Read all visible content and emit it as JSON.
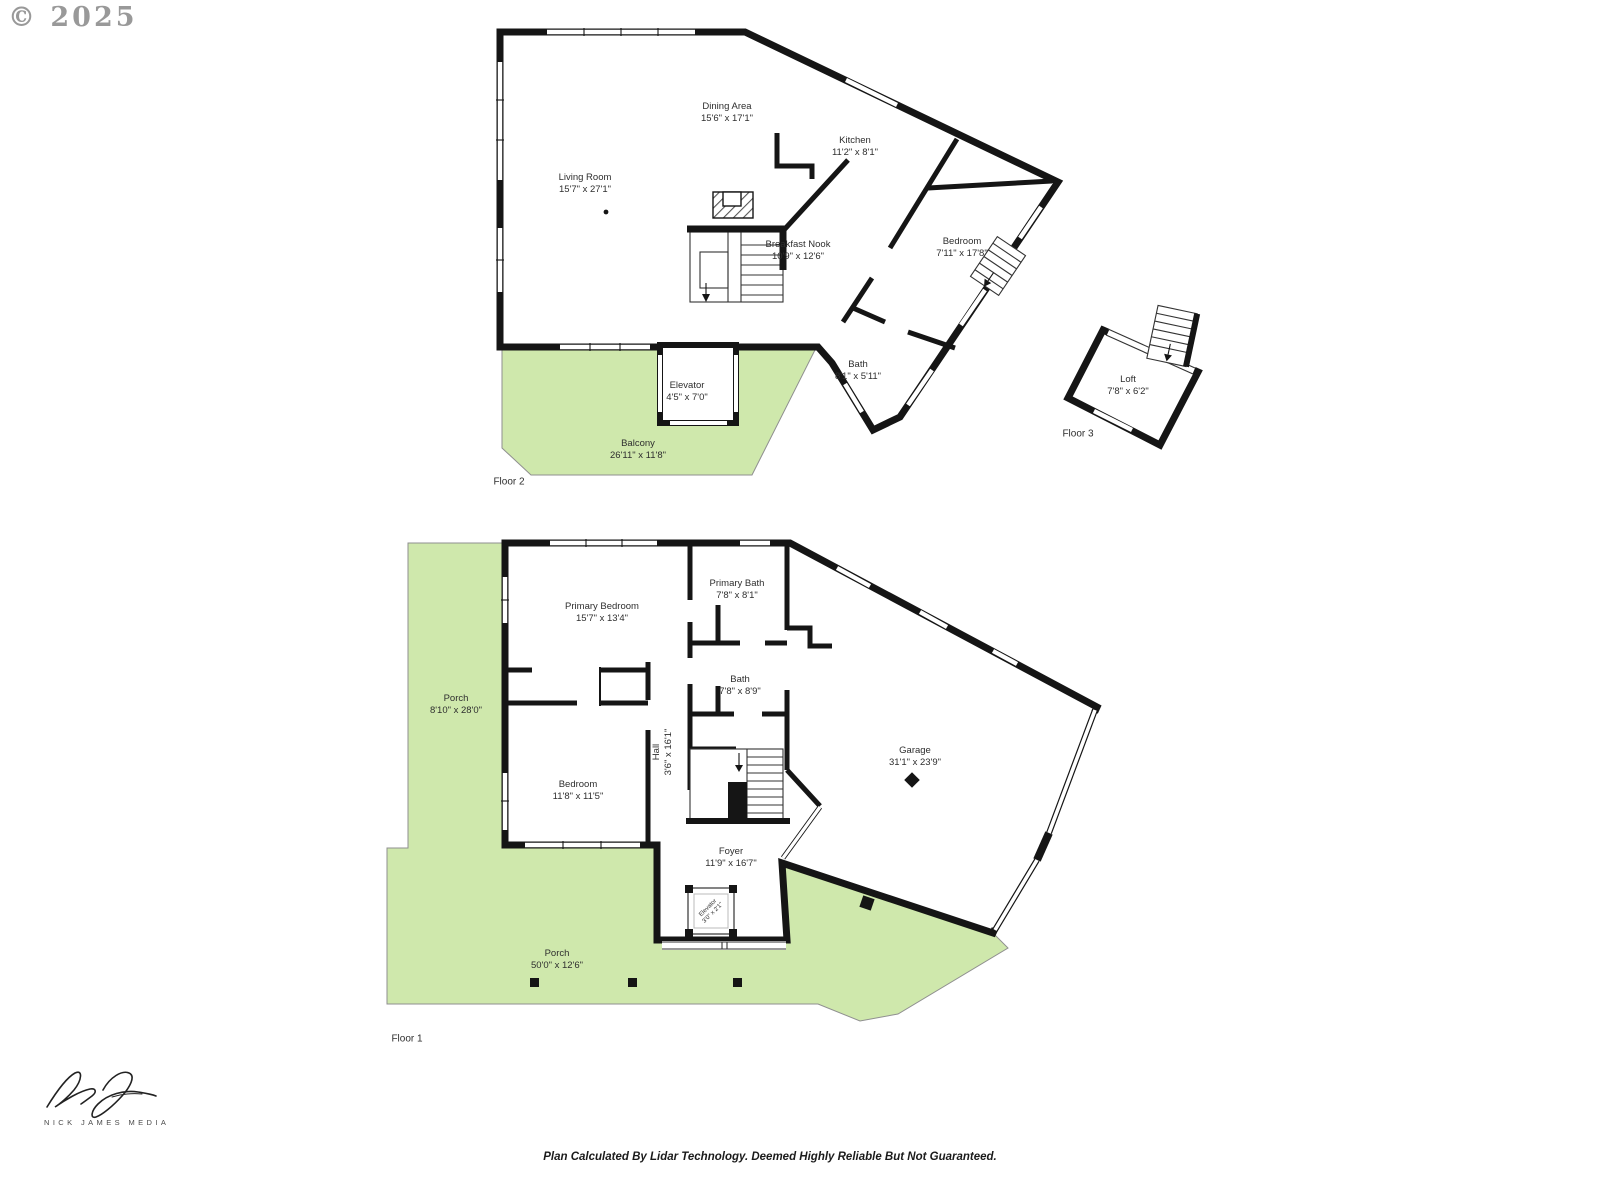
{
  "watermark": "© 2025",
  "footer": {
    "disclaimer": "Plan Calculated By Lidar Technology. Deemed Highly Reliable But Not Guaranteed."
  },
  "branding": {
    "name": "NICK JAMES MEDIA"
  },
  "colors": {
    "wall_black": "#151515",
    "deck_green": "#cfe8ac",
    "label_text": "#2e2e2e",
    "watermark_gray": "#8f8f8f"
  },
  "floors": [
    {
      "label": "Floor 1",
      "rooms": [
        {
          "name": "Porch",
          "dims": "8'10\" x 28'0\""
        },
        {
          "name": "Primary Bedroom",
          "dims": "15'7\" x 13'4\""
        },
        {
          "name": "Primary Bath",
          "dims": "7'8\" x 8'1\""
        },
        {
          "name": "Bath",
          "dims": "7'8\" x 8'9\""
        },
        {
          "name": "Hall",
          "dims": "3'6\" x 16'1\""
        },
        {
          "name": "Bedroom",
          "dims": "11'8\" x 11'5\""
        },
        {
          "name": "Foyer",
          "dims": "11'9\" x 16'7\""
        },
        {
          "name": "Elevator",
          "dims": "3'0\" x 2'1\""
        },
        {
          "name": "Garage",
          "dims": "31'1\" x 23'9\""
        },
        {
          "name": "Porch",
          "dims": "50'0\" x 12'6\""
        }
      ]
    },
    {
      "label": "Floor 2",
      "rooms": [
        {
          "name": "Living Room",
          "dims": "15'7\" x 27'1\""
        },
        {
          "name": "Dining Area",
          "dims": "15'6\" x 17'1\""
        },
        {
          "name": "Kitchen",
          "dims": "11'2\" x 8'1\""
        },
        {
          "name": "Breakfast Nook",
          "dims": "10'9\" x 12'6\""
        },
        {
          "name": "Bedroom",
          "dims": "7'11\" x 17'8\""
        },
        {
          "name": "Bath",
          "dims": "8'1\" x 5'11\""
        },
        {
          "name": "Elevator",
          "dims": "4'5\" x 7'0\""
        },
        {
          "name": "Balcony",
          "dims": "26'11\" x 11'8\""
        }
      ]
    },
    {
      "label": "Floor 3",
      "rooms": [
        {
          "name": "Loft",
          "dims": "7'8\" x 6'2\""
        }
      ]
    }
  ]
}
